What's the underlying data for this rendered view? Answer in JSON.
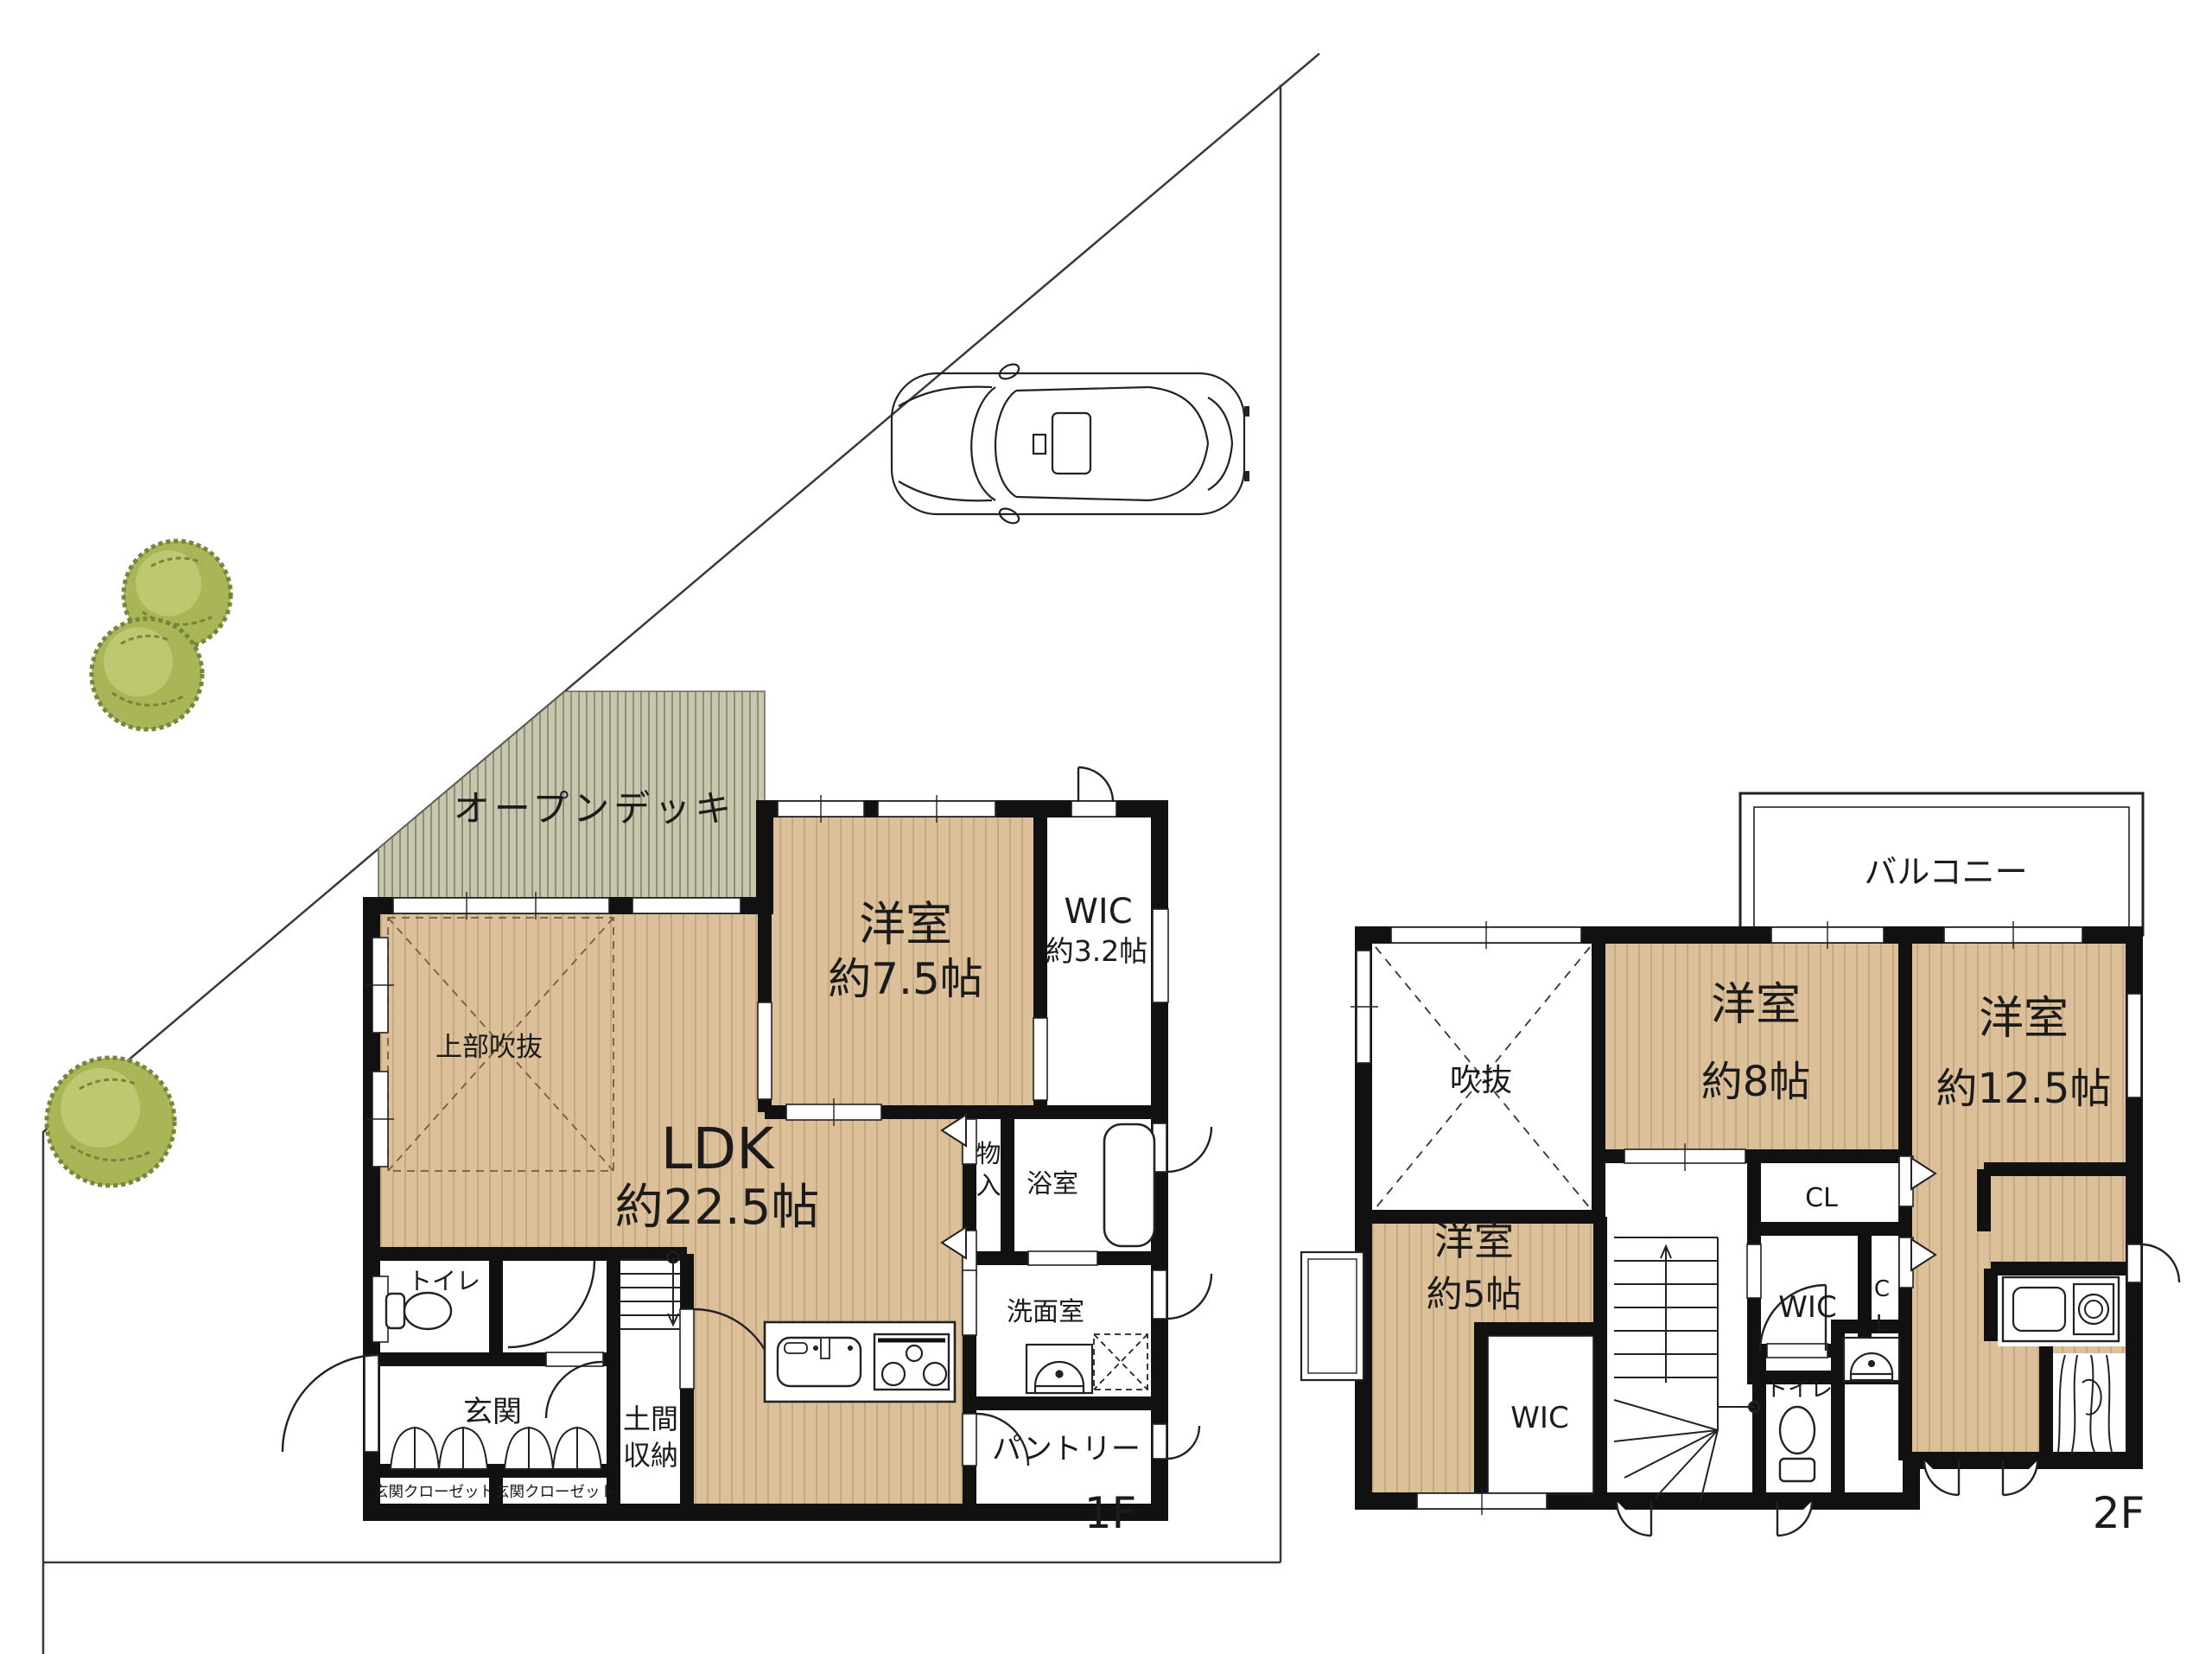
{
  "plan": {
    "floor1": {
      "floor_label": "1F",
      "open_deck": "オープンデッキ",
      "upper_void": "上部吹抜",
      "ldk_name": "LDK",
      "ldk_size": "約22.5帖",
      "bedroom_name": "洋室",
      "bedroom_size": "約7.5帖",
      "wic_name": "WIC",
      "wic_size": "約3.2帖",
      "storage_chars": [
        "物",
        "入"
      ],
      "bathroom": "浴室",
      "washroom": "洗面室",
      "toilet": "トイレ",
      "entrance": "玄関",
      "doma_chars": [
        "土間",
        "収納"
      ],
      "closet_left": "玄関クローゼット",
      "closet_right": "玄関クローゼット",
      "pantry": "パントリー"
    },
    "floor2": {
      "floor_label": "2F",
      "balcony": "バルコニー",
      "void": "吹抜",
      "bedroom8_name": "洋室",
      "bedroom8_size": "約8帖",
      "bedroom125_name": "洋室",
      "bedroom125_size": "約12.5帖",
      "bedroom5_name": "洋室",
      "bedroom5_size": "約5帖",
      "closet_cl": "CL",
      "wic_mid": "WIC",
      "closet_cl_vert": [
        "C",
        "L"
      ],
      "wic_bottom": "WIC",
      "toilet": "トイレ"
    },
    "colors": {
      "floor_wood": "#dcc09a",
      "floor_wood_stripe": "#b89a74",
      "deck": "#c9c6ae",
      "deck_stripe": "#7b7b6c",
      "wall": "#111111",
      "tree_green": "#a9b557",
      "tree_dark": "#75853b",
      "boundary_line": "#3a3a3a"
    }
  }
}
